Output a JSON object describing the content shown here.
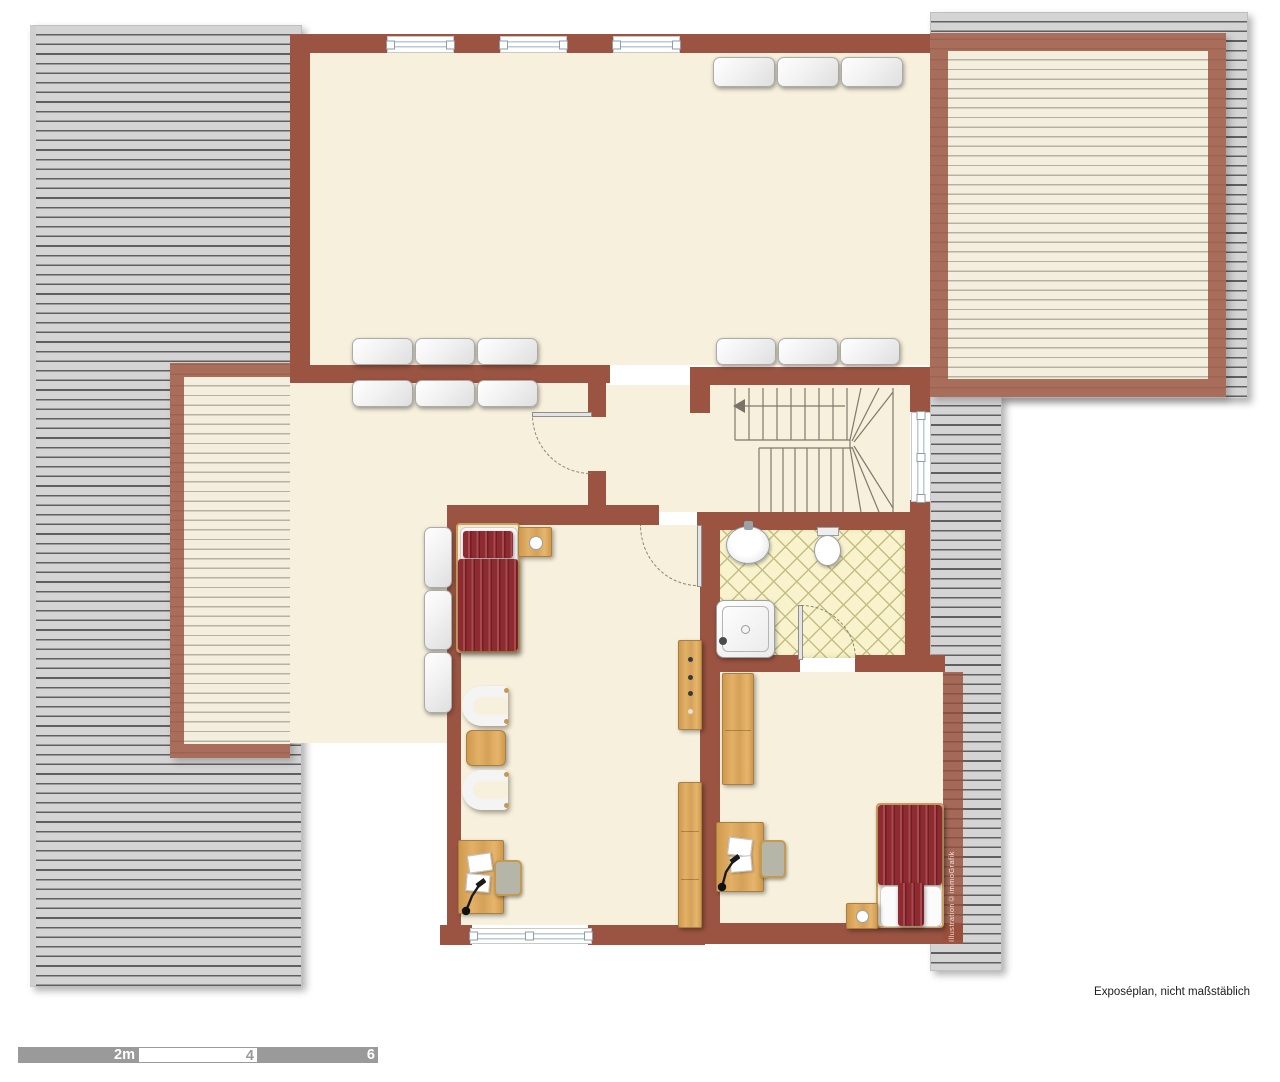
{
  "plan": {
    "footer_note": "Exposéplan, nicht maßstäblich",
    "watermark": "Illustration©immoGrafik",
    "scale_bar": {
      "labels": [
        "2m",
        "4",
        "6"
      ]
    },
    "colors": {
      "wall": "#9B5442",
      "wall_translucent": "rgba(152,78,58,0.80)",
      "room_floor": "#F7F0DD",
      "roof_gray": "#D4D4D4",
      "roof_stripe": "#5F5F5F",
      "terrace_floor": "#F3EEDD",
      "terrace_stripe": "#B8B1A0",
      "bath_tile": "#F8F3CC",
      "bath_tile_line": "#C6BD85",
      "wood": "#D9A45B",
      "bed_red": "#8E2B30",
      "window_frame_blue": "#B9CBD3",
      "scale_gray": "#9A9A9A"
    },
    "elements": {
      "roofs": [
        "roof-left",
        "roof-top-right",
        "roof-right-strip"
      ],
      "outdoor_areas": [
        "balcony-left",
        "terrace-top-right"
      ],
      "rooms": [
        "living-area",
        "left-room",
        "hallway-stairs",
        "bedroom-1",
        "bathroom",
        "bedroom-2"
      ],
      "fixtures": [
        "staircase",
        "sink",
        "toilet",
        "shower"
      ],
      "furniture": [
        "sofa",
        "radiator",
        "bed",
        "nightstand",
        "armchair",
        "side-table",
        "desk",
        "desk-chair",
        "desk-lamp",
        "dresser",
        "wardrobe"
      ]
    }
  }
}
